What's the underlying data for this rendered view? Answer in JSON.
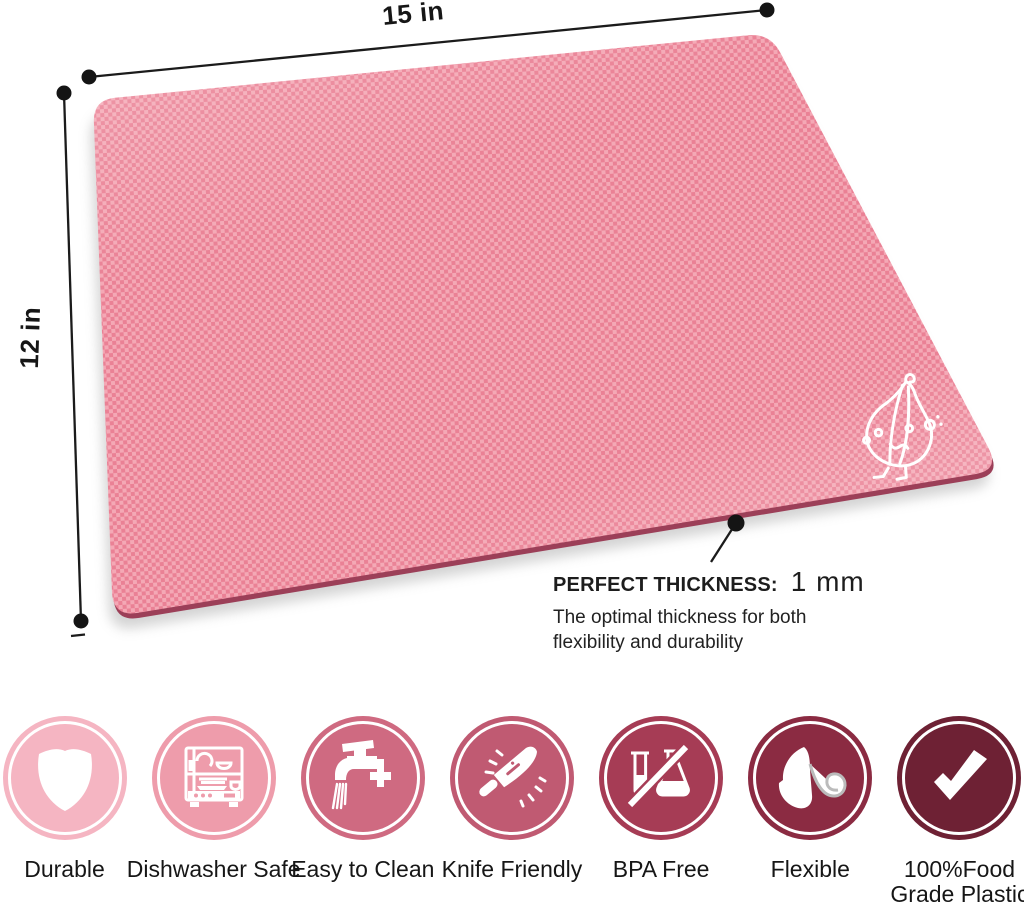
{
  "dimension_labels": {
    "width": "15 in",
    "height": "12 in"
  },
  "thickness_callout": {
    "heading": "PERFECT THICKNESS:",
    "value": "1 mm",
    "description_line1": "The optimal thickness for both",
    "description_line2": "flexibility and durability"
  },
  "mat": {
    "surface_color": "#ef8d9f",
    "texture_light": "#f4a8b5",
    "texture_dark": "#ea8195",
    "edge_color": "#9c3f58",
    "logo": "garlic-mascot"
  },
  "badges": [
    {
      "label": "Durable",
      "label_line2": "",
      "icon": "shield-icon",
      "color": "#f5b5c2"
    },
    {
      "label": "Dishwasher Safe",
      "label_line2": "",
      "icon": "dishwasher-icon",
      "color": "#ee9cab"
    },
    {
      "label": "Easy to Clean",
      "label_line2": "",
      "icon": "faucet-icon",
      "color": "#cf6a81"
    },
    {
      "label": "Knife Friendly",
      "label_line2": "",
      "icon": "knife-icon",
      "color": "#c05a72"
    },
    {
      "label": "BPA Free",
      "label_line2": "",
      "icon": "bpa-free-icon",
      "color": "#a63c55"
    },
    {
      "label": "Flexible",
      "label_line2": "",
      "icon": "flexible-icon",
      "color": "#8b2b42"
    },
    {
      "label": "100%Food",
      "label_line2": "Grade Plastic",
      "icon": "checkmark-icon",
      "color": "#6e2134"
    }
  ]
}
